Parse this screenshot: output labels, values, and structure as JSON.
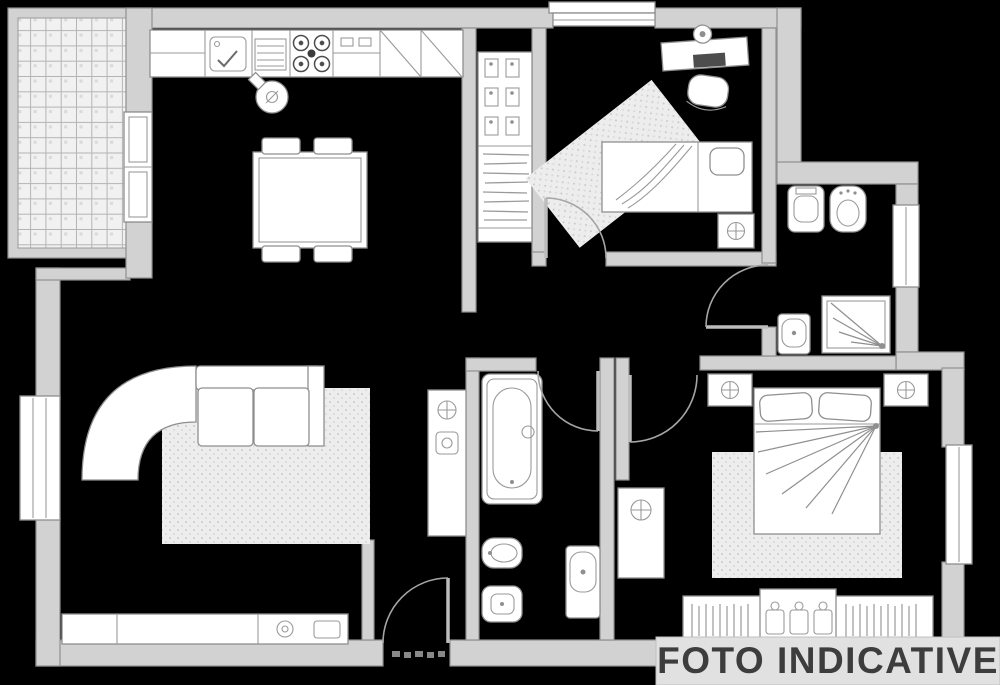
{
  "canvas": {
    "width": 1000,
    "height": 685,
    "background": "#000000"
  },
  "watermark": {
    "text": "FOTO INDICATIVE",
    "text_color": "#3d3d3d",
    "band_color": "#e1e1e1"
  },
  "palette": {
    "wall_fill": "#d2d2d2",
    "wall_stroke": "#8f8f8f",
    "fixture_fill": "#ffffff",
    "fixture_stroke": "#8f8f8f",
    "rug_fill": "#ededed",
    "rug_dot": "#c9c9c9",
    "tile_fill": "#f1f1f1",
    "tile_line": "#b5b5b5",
    "dark_detail": "#4d4d4d"
  },
  "plan": {
    "type": "apartment-floor-plan",
    "rooms": [
      {
        "name": "balcony",
        "furniture": [
          "tile-floor-grid",
          "balcony-door"
        ]
      },
      {
        "name": "kitchen",
        "furniture": [
          "counter-cabinet",
          "kitchen-sink",
          "drainer",
          "stove-4-burners",
          "cabinet",
          "appliance-diagonal",
          "appliance-diagonal",
          "kettle",
          "dining-table",
          "chair",
          "chair",
          "chair",
          "chair"
        ]
      },
      {
        "name": "hallway",
        "furniture": [
          "closet-shoe-shelves",
          "closet-hanging-clothes"
        ]
      },
      {
        "name": "bedroom-single",
        "furniture": [
          "desk",
          "desk-lamp",
          "laptop",
          "chair",
          "single-bed",
          "pillow",
          "nightstand-plant",
          "rug-diagonal",
          "door-arc"
        ]
      },
      {
        "name": "bathroom-top-right",
        "furniture": [
          "toilet",
          "bidet",
          "shower-corner",
          "washbasin",
          "window",
          "door-arc"
        ]
      },
      {
        "name": "bathroom-middle",
        "furniture": [
          "bathtub",
          "bidet",
          "toilet",
          "washbasin",
          "door-arc"
        ]
      },
      {
        "name": "living-room",
        "furniture": [
          "corner-sofa-curved",
          "rug",
          "sideboard",
          "plate",
          "plant-shelf",
          "window",
          "entry-door-arc"
        ]
      },
      {
        "name": "bedroom-master",
        "furniture": [
          "double-bed",
          "pillow",
          "pillow",
          "nightstand-plant",
          "nightstand-plant",
          "rug",
          "plant-table",
          "wardrobe-hangers",
          "wardrobe-shelves",
          "window",
          "door-arc"
        ]
      }
    ],
    "window_count": 5,
    "door_count": 6
  }
}
